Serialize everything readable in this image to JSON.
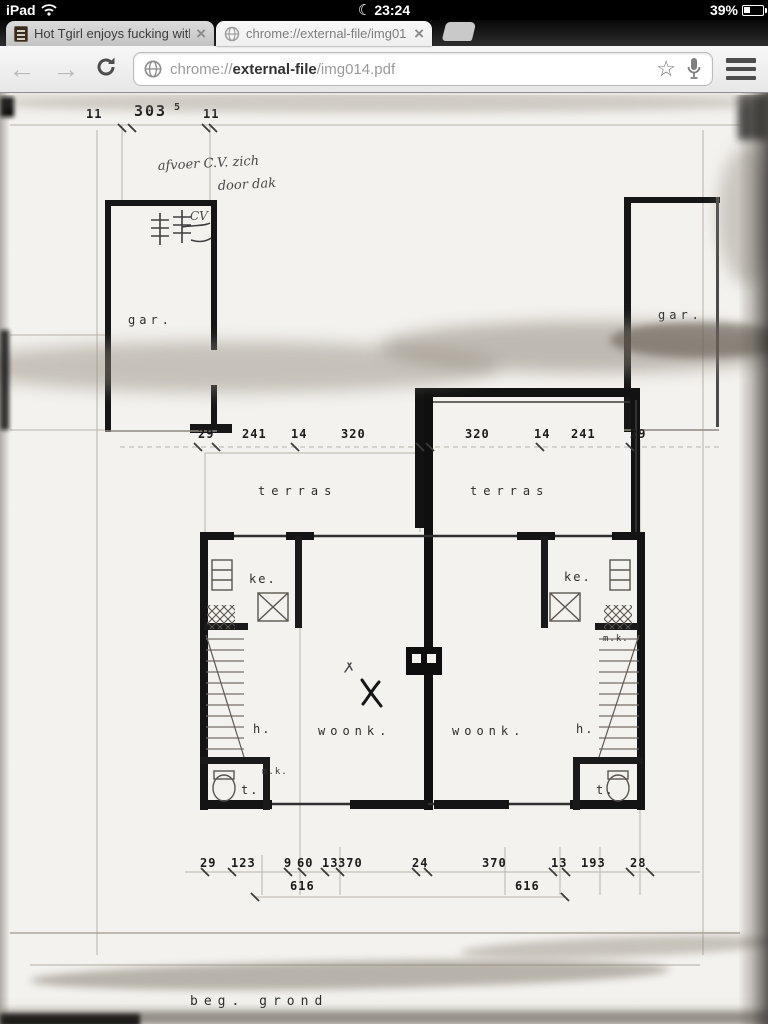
{
  "status_bar": {
    "device": "iPad",
    "time": "23:24",
    "battery_percent": "39%"
  },
  "icons": {
    "moon": "☾",
    "close": "×",
    "star": "☆",
    "back": "←",
    "forward": "→"
  },
  "tab_strip": {
    "tabs": [
      {
        "title": "Hot Tgirl enjoys fucking with",
        "icon": "page-favicon"
      },
      {
        "title": "chrome://external-file/img01",
        "icon": "globe-favicon"
      }
    ]
  },
  "toolbar": {
    "url_scheme": "chrome://",
    "url_host": "external-file",
    "url_path": "/img014.pdf"
  },
  "plan": {
    "top_dims": {
      "left": "11",
      "center": "303",
      "center_sup": "5",
      "right": "11"
    },
    "note": {
      "line1": "afvoer C.V. zich",
      "line2": "door dak"
    },
    "cv_sketch_label": "CV",
    "garage_left_label": "gar.",
    "garage_right_label": "gar.",
    "mid_dims_left": [
      "29",
      "241",
      "14",
      "320"
    ],
    "mid_dims_right": [
      "320",
      "14",
      "241",
      "29"
    ],
    "terras_left": "terras",
    "terras_right": "terras",
    "room_labels": {
      "ke_left": "ke.",
      "ke_right": "ke.",
      "woonk_left": "woonk.",
      "woonk_right": "woonk.",
      "h_left": "h.",
      "h_right": "h.",
      "t_left": "t.",
      "t_right": "t.",
      "mk_left": "m.k.",
      "mk_right": "m.k."
    },
    "bottom_dims": [
      "29",
      "123",
      "9",
      "60",
      "13",
      "370",
      "24",
      "370",
      "13",
      "193",
      "28"
    ],
    "totals": [
      "616",
      "616"
    ],
    "floor_label": "beg. grond"
  }
}
